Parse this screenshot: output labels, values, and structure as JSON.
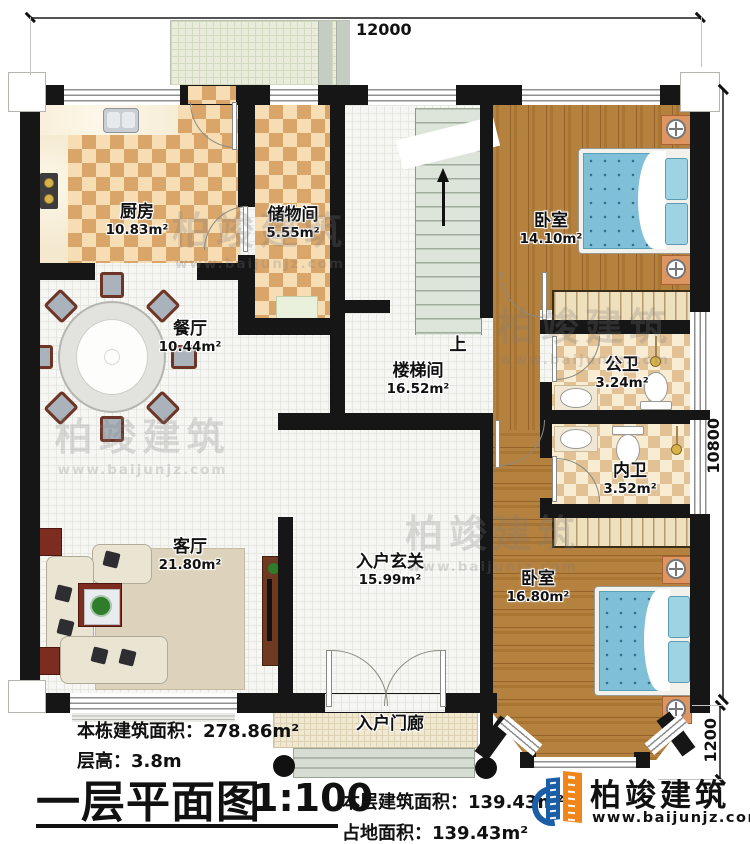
{
  "dimensions": {
    "top_width": "12000",
    "right_height": "10800",
    "bay_depth": "1200"
  },
  "rooms": [
    {
      "id": "kitchen",
      "name": "厨房",
      "area": "10.83m²"
    },
    {
      "id": "storage",
      "name": "储物间",
      "area": "5.55m²"
    },
    {
      "id": "dining",
      "name": "餐厅",
      "area": "10.44m²"
    },
    {
      "id": "bedroom-1",
      "name": "卧室",
      "area": "14.10m²"
    },
    {
      "id": "stairwell",
      "name": "楼梯间",
      "area": "16.52m²"
    },
    {
      "id": "public-bath",
      "name": "公卫",
      "area": "3.24m²"
    },
    {
      "id": "private-bath",
      "name": "内卫",
      "area": "3.52m²"
    },
    {
      "id": "living",
      "name": "客厅",
      "area": "21.80m²"
    },
    {
      "id": "foyer",
      "name": "入户玄关",
      "area": "15.99m²"
    },
    {
      "id": "bedroom-2",
      "name": "卧室",
      "area": "16.80m²"
    },
    {
      "id": "porch",
      "name": "入户门廊",
      "area": ""
    }
  ],
  "stairs": {
    "up_label": "上"
  },
  "title_block": {
    "total_area": "本栋建筑面积：278.86m²",
    "floor_height": "层高：3.8m",
    "plan_title": "一层平面图",
    "scale": "1:100",
    "floor_area": "本层建筑面积：139.43m²",
    "land_area": "占地面积：139.43m²"
  },
  "branding": {
    "logo_name": "柏竣建筑",
    "logo_url": "www.baijunjz.com",
    "colors": {
      "logo_blue": "#1b5ea6",
      "logo_orange": "#f08519"
    }
  },
  "watermark": {
    "name": "柏竣建筑",
    "url": "www.baijunjz.com"
  }
}
